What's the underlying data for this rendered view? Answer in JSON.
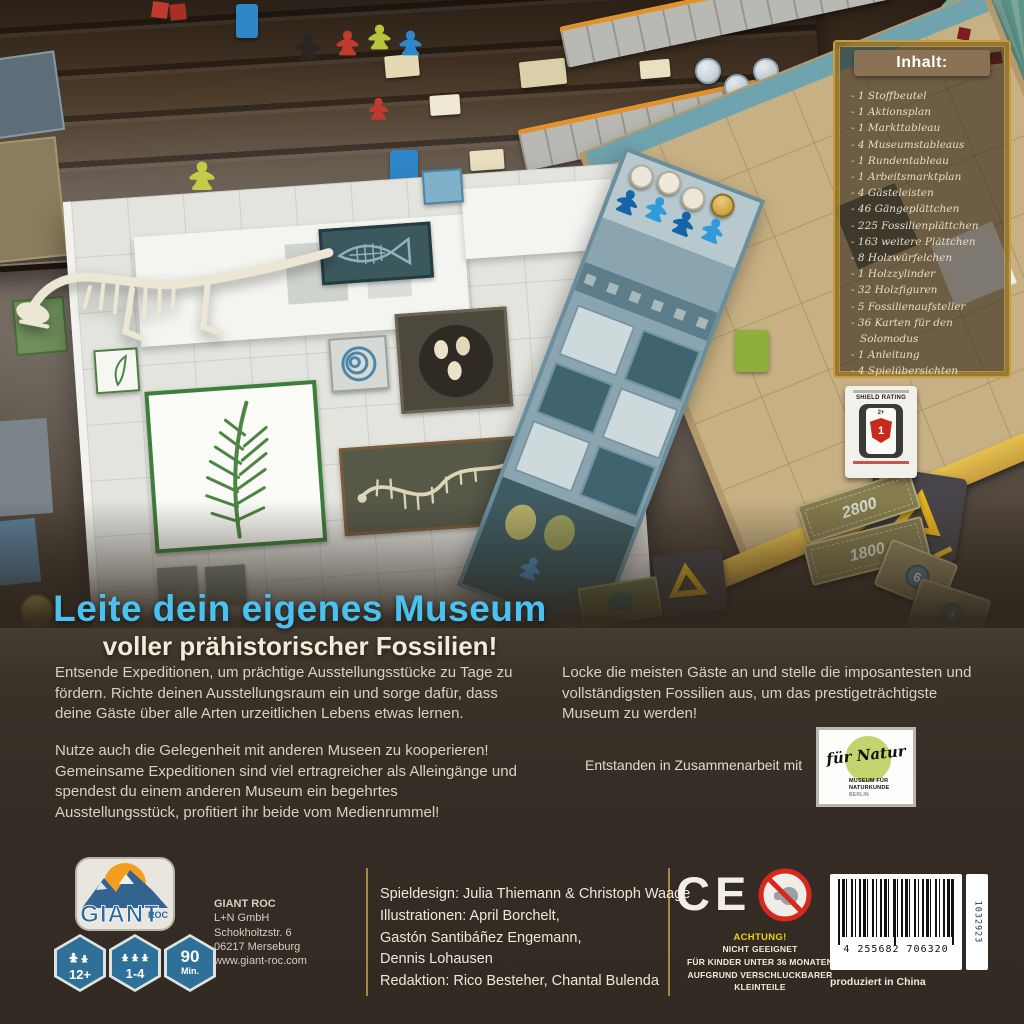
{
  "bubble": {
    "line1": "Plättchenlegespiel",
    "line2": "mit positiver",
    "line3": "Interaktion!"
  },
  "inhalt": {
    "title": "Inhalt:",
    "items": [
      "1 Stoffbeutel",
      "1 Aktionsplan",
      "1 Markttableau",
      "4 Museumstableaus",
      "1 Rundentableau",
      "1 Arbeitsmarktplan",
      "4 Gästeleisten",
      "46 Gängeplättchen",
      "225 Fossilienplättchen",
      "163 weitere Plättchen",
      "8 Holzwürfelchen",
      "1 Holzzylinder",
      "32 Holzfiguren",
      "5 Fossilienaufsteller",
      "36 Karten für den Solomodus",
      "1 Anleitung",
      "4 Spielübersichten"
    ]
  },
  "headline": {
    "line1": "Leite dein eigenes Museum",
    "line2": "voller prähistorischer Fossilien!"
  },
  "body": {
    "left_para1": "Entsende Expeditionen, um prächtige Ausstellungsstücke zu Tage zu fördern. Richte deinen Ausstellungsraum ein und sorge dafür, dass deine Gäste über alle Arten urzeitlichen Lebens etwas lernen.",
    "left_para2": "Nutze auch die Gelegenheit mit anderen Museen zu kooperieren! Gemeinsame Expeditionen sind viel ertragreicher als Alleingänge und spendest du einem anderen Museum ein begehrtes Ausstellungsstück, profitiert ihr beide vom Medienrummel!",
    "right_para": "Locke die meisten Gäste an und stelle die imposantesten und vollständigsten Fossilien aus, um das prestigeträchtigste Museum zu werden!"
  },
  "collab": {
    "label": "Entstanden in Zusammenarbeit mit",
    "logo_script": "für Natur",
    "logo_line1": "MUSEUM FÜR",
    "logo_line2": "NATURKUNDE",
    "logo_line3": "BERLIN"
  },
  "shield": {
    "title": "SHIELD RATING",
    "age": "2+",
    "rating": "1"
  },
  "photo": {
    "bill1": "2800",
    "bill2": "1800",
    "card1": "6",
    "card2": "4"
  },
  "footer": {
    "brand": {
      "name": "GIANT",
      "sub": "ROC"
    },
    "address": [
      "GIANT ROC",
      "L+N GmbH",
      "Schokholtzstr. 6",
      "06217 Merseburg",
      "www.giant-roc.com"
    ],
    "badges": {
      "age": "12+",
      "players": "1-4",
      "time": "90",
      "time_unit": "Min."
    },
    "credits": [
      "Spieldesign: Julia Thiemann & Christoph Waage",
      "Illustrationen: April Borchelt,",
      "Gastón Santibáñez Engemann,",
      "Dennis Lohausen",
      "Redaktion: Rico Besteher, Chantal Bulenda"
    ],
    "ce": "CE",
    "warning": {
      "title": "ACHTUNG!",
      "lines": [
        "NICHT GEEIGNET",
        "FÜR KINDER UNTER 36 MONATEN",
        "AUFGRUND VERSCHLUCKBARER",
        "KLEINTEILE"
      ]
    },
    "barcode": {
      "number": "4 255682 706320",
      "side": "1032923",
      "made_in": "produziert in China"
    }
  },
  "colors": {
    "headline_blue": "#4ac1ef",
    "gold": "#c79d3e",
    "panel_brown": "#352d25"
  }
}
